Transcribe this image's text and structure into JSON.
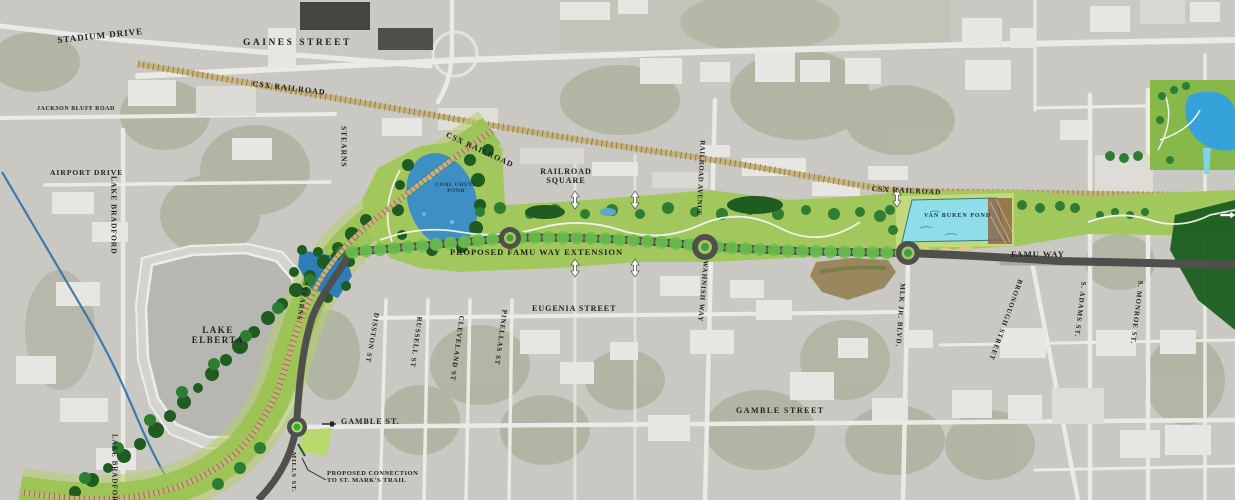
{
  "map": {
    "description": "Aerial site plan of proposed FAMU Way extension corridor",
    "labels": {
      "stadium_drive": "STADIUM DRIVE",
      "gaines_street": "GAINES STREET",
      "csx_railroad_west": "CSX RAILROAD",
      "csx_railroad_center": "CSX RAILROAD",
      "csx_railroad_east": "CSX RAILROAD",
      "jackson_bluff_road": "JACKSON BLUFF ROAD",
      "airport_drive": "AIRPORT DRIVE",
      "lake_bradford_north": "LAKE BRADFORD",
      "lake_bradford_south": "LAKE BRADFORD",
      "stearns_north": "STEARNS",
      "stearns_south": "STEARNS",
      "coal_chute_pond": "COAL CHUTE POND",
      "railroad_square": "RAILROAD SQUARE",
      "railroad_avenue": "RAILROAD AVENUE",
      "proposed_famu_way_extension": "PROPOSED FAMU WAY EXTENSION",
      "eugenia_street": "EUGENIA STREET",
      "disston_st": "DISSTON ST",
      "russell_st": "RUSSELL ST",
      "cleveland_st": "CLEVELAND ST",
      "pinellas_st": "PINELLAS ST",
      "wahnish_way": "WAHNISH WAY",
      "mlk_jr_blvd": "MLK JR. BLVD.",
      "gamble_street": "GAMBLE STREET",
      "gamble_st": "GAMBLE ST.",
      "mills_st": "MILLS ST.",
      "proposed_connection": "PROPOSED CONNECTION TO ST. MARK'S TRAIL",
      "lake_elberta": "LAKE ELBERTA",
      "van_buren_pond": "VAN BUREN POND",
      "famu_way": "FAMU WAY",
      "bronough_street": "BRONOUGH STREET",
      "s_adams_st": "S. ADAMS ST.",
      "s_monroe_st": "S. MONROE ST."
    },
    "colors": {
      "aerial_base": "#c9c8c3",
      "corridor_green": "#a2c75c",
      "park_green": "#86b84a",
      "tree_dark": "#1e5c22",
      "tree_mid": "#2e7d32",
      "pond_blue": "#3e8fc4",
      "van_buren_cyan": "#8fdde8",
      "cascade_pond_blue": "#35a3d9",
      "railroad_tan": "#c8b27c",
      "railroad_tie": "#7d6b40",
      "lake_gray": "#b7b7b2",
      "stream_blue": "#2d6fa8",
      "road_dark": "#4f4f4d",
      "label_text": "#222222"
    }
  }
}
